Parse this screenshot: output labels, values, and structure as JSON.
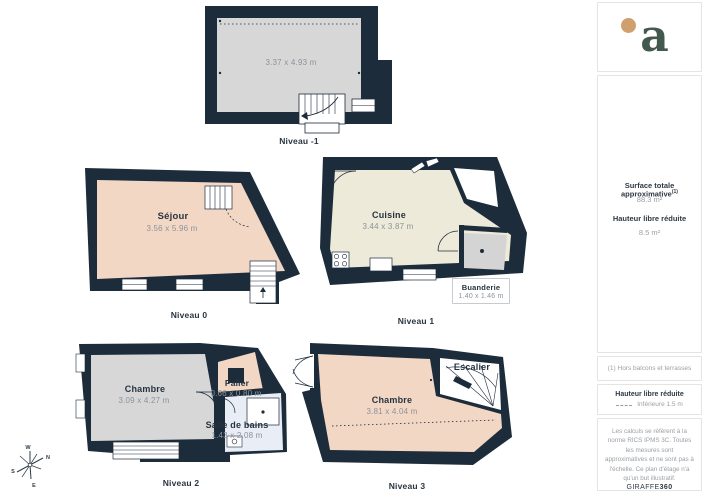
{
  "floors": {
    "m1": {
      "label": "Niveau -1",
      "room": {
        "name": "",
        "dims": "3.37 x 4.93 m"
      }
    },
    "n0": {
      "label": "Niveau 0",
      "room": {
        "name": "Séjour",
        "dims": "3.56 x 5.96 m"
      }
    },
    "n1": {
      "label": "Niveau 1",
      "room": {
        "name": "Cuisine",
        "dims": "3.44 x 3.87 m"
      },
      "annex": {
        "name": "Buanderie",
        "dims": "1.40 x 1.46 m"
      }
    },
    "n2": {
      "label": "Niveau 2",
      "room": {
        "name": "Chambre",
        "dims": "3.09 x 4.27 m"
      },
      "palier": {
        "name": "Palier",
        "dims": "0.66 x 0.80 m"
      },
      "bath": {
        "name": "Salle de bains",
        "dims": "1.43 x 2.08 m"
      }
    },
    "n3": {
      "label": "Niveau 3",
      "room": {
        "name": "Chambre",
        "dims": "3.81 x 4.04 m"
      },
      "stair": {
        "name": "Escalier"
      }
    }
  },
  "compass": {
    "n": "N",
    "s": "S",
    "e": "E",
    "w": "W"
  },
  "sidebar": {
    "logo": "a",
    "surface_title": "Surface totale approximative",
    "surface_footnote_marker": "(1)",
    "surface_value": "88.3 m²",
    "reduced_title": "Hauteur libre réduite",
    "reduced_value": "8.5 m²",
    "footnote": "(1) Hors balcons et terrasses",
    "legend_title": "Hauteur libre réduite",
    "legend_value": "Inférieure 1.5 m",
    "disclaimer": "Les calculs se réfèrent à la norme RICS IPMS 3C. Toutes les mesures sont approximatives et ne sont pas à l'échelle. Ce plan d'étage n'a qu'un but illustratif.",
    "brand_name": "GIRAFFE",
    "brand_suffix": "360"
  },
  "colors": {
    "wall": "#1d2c3b",
    "floor_gray": "#d7d7d7",
    "floor_salmon": "#f3d7c5",
    "floor_cream": "#eeead9",
    "floor_blue": "#e9edf5",
    "logo_green": "#44594d",
    "logo_dot": "#cfa06d"
  }
}
